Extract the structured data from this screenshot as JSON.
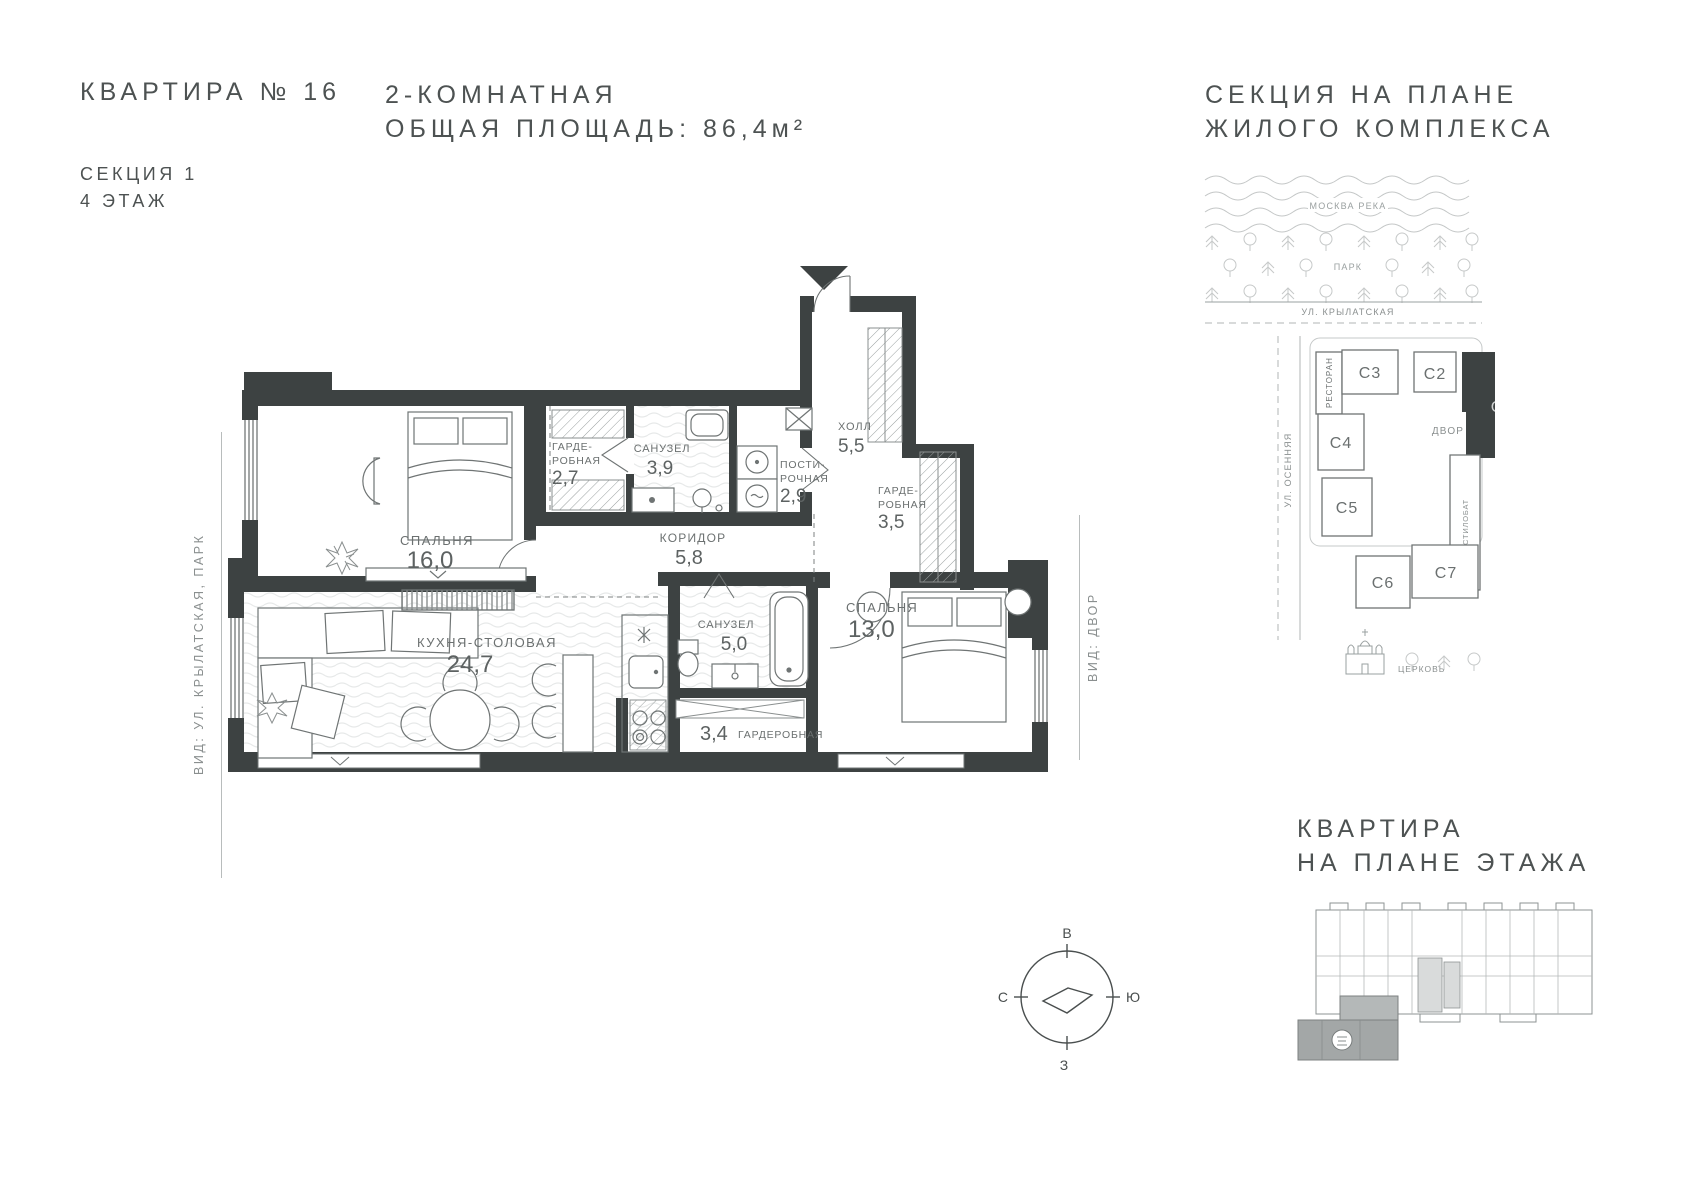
{
  "header": {
    "apartment_title": "КВАРТИРА № 16",
    "section": "СЕКЦИЯ 1",
    "floor": "4 ЭТАЖ",
    "apartment_type": "2-КОМНАТНАЯ",
    "total_area": "ОБЩАЯ ПЛОЩАДЬ: 86,4м²"
  },
  "site_plan": {
    "title_line1": "СЕКЦИЯ НА ПЛАНЕ",
    "title_line2": "ЖИЛОГО КОМПЛЕКСА",
    "river": "МОСКВА РЕКА",
    "park": "ПАРК",
    "street_top": "УЛ. КРЫЛАТСКАЯ",
    "street_left": "УЛ. ОСЕННЯЯ",
    "restaurant": "РЕСТОРАН",
    "courtyard": "ДВОР",
    "stylobate": "СТИЛОБАТ",
    "church": "ЦЕРКОВЬ",
    "highlighted_section": "С1",
    "sections": [
      "С1",
      "С2",
      "С3",
      "С4",
      "С5",
      "С6",
      "С7"
    ],
    "accent_color": "#3d4242"
  },
  "plan": {
    "views": {
      "left": "ВИД: УЛ. КРЫЛАТСКАЯ, ПАРК",
      "right": "ВИД: ДВОР"
    },
    "rooms": [
      {
        "line1": "СПАЛЬНЯ",
        "area": "16,0"
      },
      {
        "line1": "ГАРДЕ-",
        "line2": "РОБНАЯ",
        "area": "2,7"
      },
      {
        "line1": "САНУЗЕЛ",
        "area": "3,9"
      },
      {
        "line1": "ПОСТИ-",
        "line2": "РОЧНАЯ",
        "area": "2,9"
      },
      {
        "line1": "ХОЛЛ",
        "area": "5,5"
      },
      {
        "line1": "ГАРДЕ-",
        "line2": "РОБНАЯ",
        "area": "3,5"
      },
      {
        "line1": "КОРИДОР",
        "area": "5,8"
      },
      {
        "line1": "КУХНЯ-СТОЛОВАЯ",
        "area": "24,7"
      },
      {
        "line1": "САНУЗЕЛ",
        "area": "5,0"
      },
      {
        "line1": "СПАЛЬНЯ",
        "area": "13,0"
      },
      {
        "line1": "ГАРДЕРОБНАЯ",
        "area": "3,4"
      }
    ],
    "wall_color": "#3d4242"
  },
  "compass": {
    "top": "В",
    "right": "Ю",
    "bottom": "З",
    "left": "С"
  },
  "floor_plan_mini": {
    "title_line1": "КВАРТИРА",
    "title_line2": "НА ПЛАНЕ ЭТАЖА"
  }
}
